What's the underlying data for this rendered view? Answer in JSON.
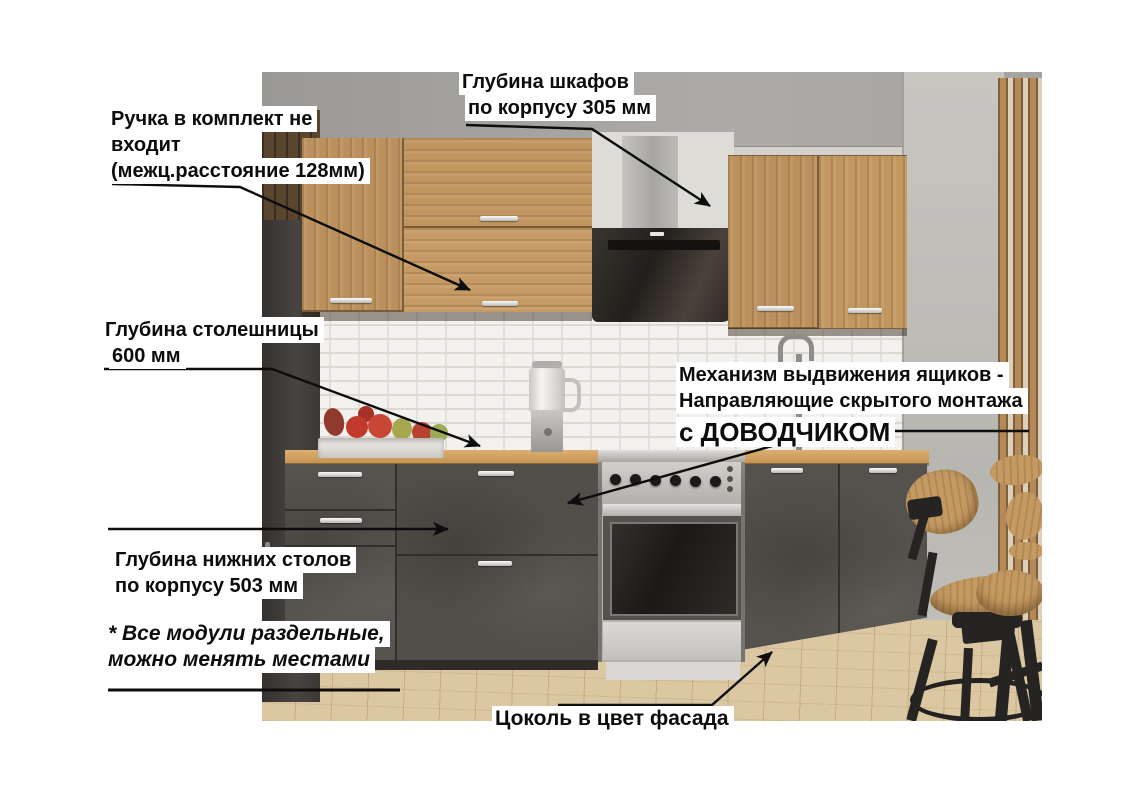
{
  "annotations": {
    "handle_note": {
      "line1": "Ручка в комплект не",
      "line2": "входит",
      "line3": "(межц.расстояние 128мм)"
    },
    "cabinet_depth": {
      "line1": "Глубина шкафов",
      "line2": "по корпусу 305 мм"
    },
    "countertop_depth": {
      "line1": "Глубина столешницы",
      "line2": "600 мм"
    },
    "drawer_mechanism": {
      "line1": "Механизм выдвижения ящиков -",
      "line2": "Направляющие скрытого монтажа",
      "line3": "с ДОВОДЧИКОМ"
    },
    "base_depth": {
      "line1": "Глубина нижних столов",
      "line2": "по корпусу 503 мм"
    },
    "modules_note": {
      "line1": "* Все модули раздельные,",
      "line2": "можно менять местами"
    },
    "plinth_note": {
      "line1": "Цоколь в цвет фасада"
    }
  },
  "colors": {
    "annotation_text": "#0c0c0c",
    "annotation_bg": "#ffffff",
    "arrow": "#0d0d0d",
    "facade_dark_gray": "#57534e",
    "oak_wood": "#bb905c",
    "countertop_oak": "#cfa05f",
    "backsplash_white": "#f3f1ed",
    "floor_light_oak": "#dbc8a2",
    "wall_gray": "#d3d1cc"
  }
}
